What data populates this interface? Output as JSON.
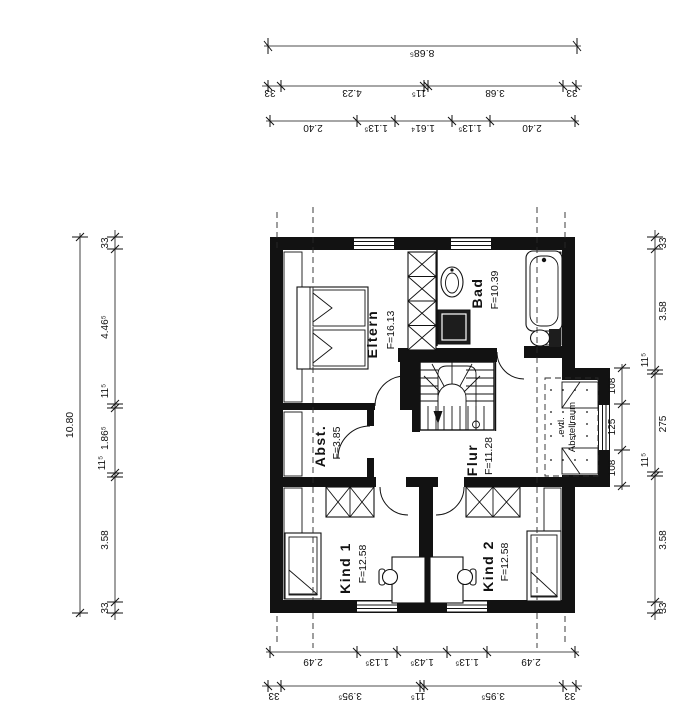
{
  "rooms": {
    "eltern": {
      "label": "Eltern",
      "area": "F=16.13"
    },
    "bad": {
      "label": "Bad",
      "area": "F=10.39"
    },
    "abst": {
      "label": "Abst.",
      "area": "F=3.85"
    },
    "flur": {
      "label": "Flur",
      "area": "F=11.28"
    },
    "kind1": {
      "label": "Kind 1",
      "area": "F=12.58"
    },
    "kind2": {
      "label": "Kind 2",
      "area": "F=12.58"
    },
    "evtl": {
      "line1": "evtl.",
      "line2": "Abstellraum"
    }
  },
  "dims": {
    "top": {
      "total": "8.68⁵",
      "row2": [
        "33",
        "4.23",
        "11⁵",
        "3.68",
        "33"
      ],
      "row3": [
        "2.40",
        "1.13⁵",
        "1.61⁴",
        "1.13⁵",
        "2.40"
      ]
    },
    "bottom": {
      "row1": [
        "2.49",
        "1.13⁵",
        "1.43⁵",
        "1.13⁵",
        "2.49"
      ],
      "row2": [
        "33",
        "3.95⁵",
        "11⁵",
        "3.95⁵",
        "33"
      ]
    },
    "left": {
      "total": "10.80",
      "chain": [
        "33",
        "4.46⁵",
        "11⁵",
        "1.86⁵",
        "11⁵",
        "3.58",
        "33"
      ]
    },
    "right": {
      "chain": [
        "33",
        "3.58",
        "11⁵",
        "275",
        "11⁵",
        "3.58",
        "33"
      ],
      "inner": [
        "108",
        "125",
        "108"
      ]
    }
  }
}
